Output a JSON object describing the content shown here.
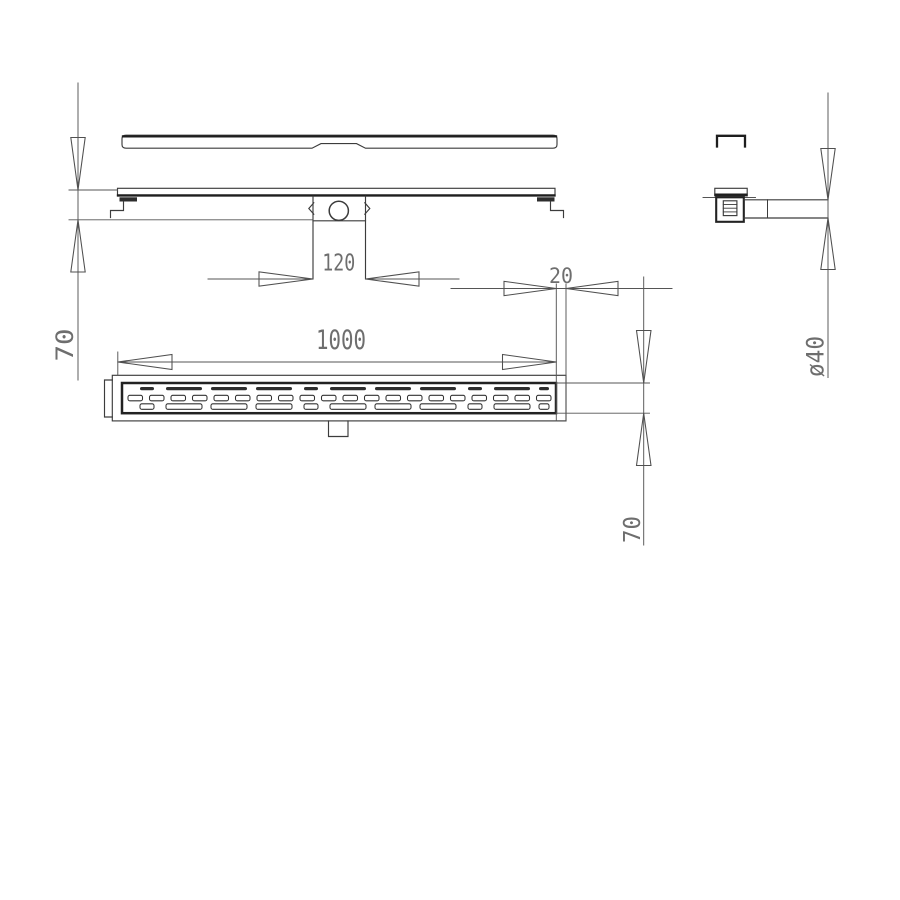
{
  "page": {
    "background": "#ffffff"
  },
  "drawing": {
    "type": "technical-drawing",
    "line_color": "#3c3c3c",
    "text_color": "#6e6e6e",
    "dimension_labels": {
      "trap_width": "120",
      "flange_offset": "20",
      "drain_length": "1000",
      "install_height": "70",
      "grate_width": "70",
      "pipe_diameter": "ø40"
    }
  }
}
